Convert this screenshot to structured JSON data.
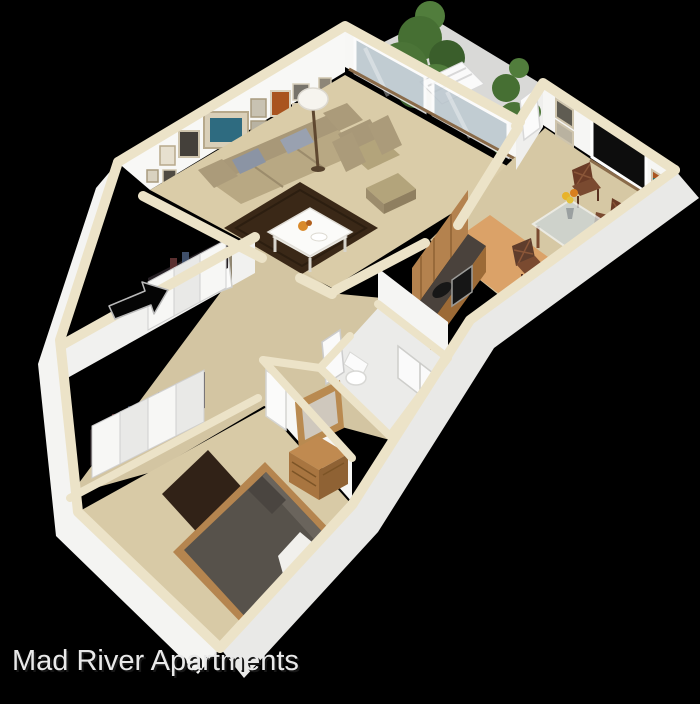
{
  "image": {
    "type": "3d-isometric-floor-plan-rendering",
    "background_color": "#000000",
    "unit_style": "one-bedroom apartment"
  },
  "title": {
    "text": "Mad River Apartments"
  },
  "palette": {
    "background": "#000000",
    "wall_cap_cream": "#ece3c8",
    "wall_face_white": "#f6f6f4",
    "exterior_face_shaded": "#e9e9e7",
    "carpet_tan": "#d8caa6",
    "wood_floor": "#dba268",
    "dark_rug_brown": "#3a2817",
    "sofa_tan": "#b3a47c",
    "accent_pillow_gray": "#8b94a4",
    "bed_mattress_gray": "#57524b",
    "wood_furniture": "#b4824e",
    "counter_dark": "#4a423c",
    "tree_green": "#4b7437",
    "window_glass": "#b6c3cb",
    "title_text": "#e9e9e9"
  },
  "scene": {
    "rooms": [
      {
        "name": "living-room",
        "furniture": [
          "sofa",
          "accent-pillows",
          "coffee-table",
          "armchair",
          "ottoman",
          "floor-lamp",
          "area-rug",
          "gallery-wall-frames",
          "windows"
        ]
      },
      {
        "name": "balcony",
        "furniture": [
          "lounge-chair",
          "tall-trees"
        ]
      },
      {
        "name": "kitchen",
        "furniture": [
          "cabinets",
          "counter",
          "sink",
          "stove"
        ]
      },
      {
        "name": "dining-area",
        "furniture": [
          "glass-table",
          "wood-chairs",
          "flower-vase",
          "window",
          "wall-frames",
          "book-shelf"
        ]
      },
      {
        "name": "hallway-entry",
        "furniture": [
          "entry-door",
          "closet-bifold-doors"
        ]
      },
      {
        "name": "bathroom",
        "furniture": [
          "toilet",
          "shower-stall",
          "door"
        ]
      },
      {
        "name": "bedroom",
        "furniture": [
          "bed",
          "white-blanket",
          "dresser",
          "mirror",
          "closet-bifold-doors",
          "area-rug"
        ]
      }
    ],
    "annotations": [
      {
        "name": "entry-arrow",
        "meaning": "points to apartment entry door"
      }
    ]
  }
}
